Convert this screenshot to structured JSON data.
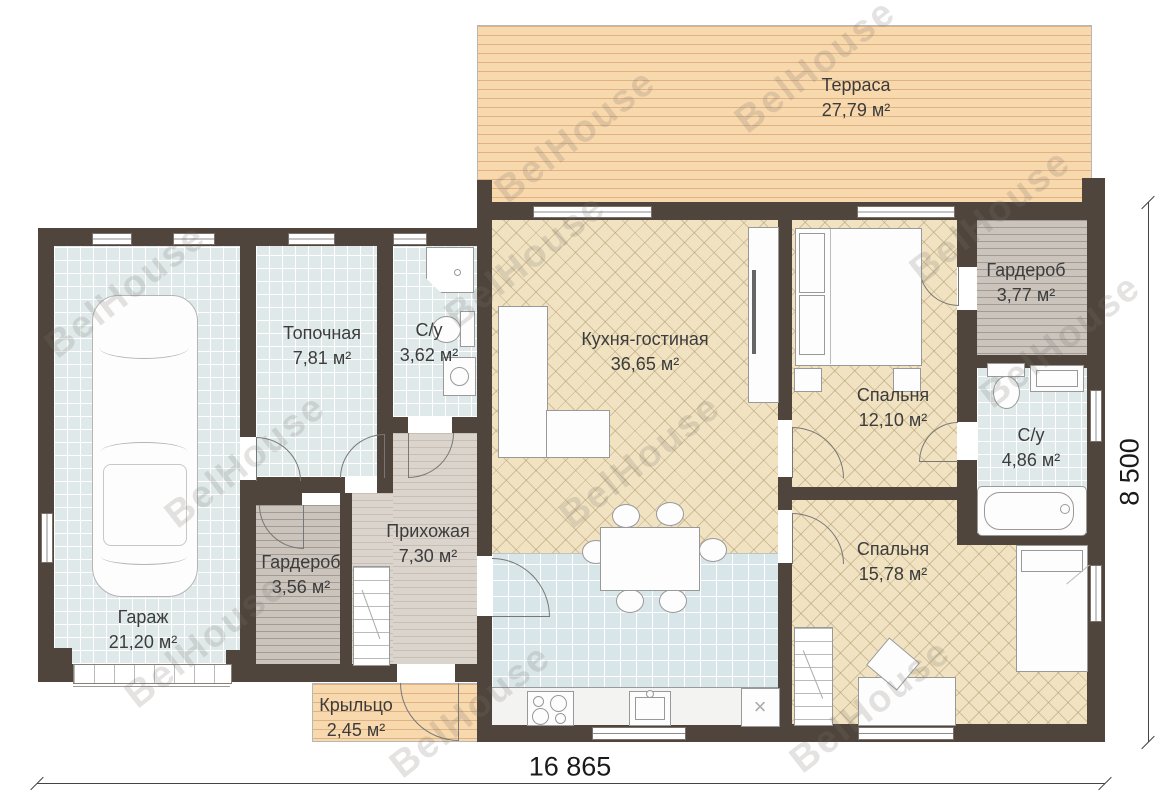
{
  "watermark": "BelHouse",
  "rooms": [
    {
      "name": "Терраса",
      "area": "27,79 м²"
    },
    {
      "name": "Гараж",
      "area": "21,20 м²"
    },
    {
      "name": "Топочная",
      "area": "7,81 м²"
    },
    {
      "name": "С/у",
      "area": "3,62 м²"
    },
    {
      "name": "Кухня-гостиная",
      "area": "36,65 м²"
    },
    {
      "name": "Спальня",
      "area": "12,10 м²"
    },
    {
      "name": "Гардероб",
      "area": "3,77 м²"
    },
    {
      "name": "С/у",
      "area": "4,86 м²"
    },
    {
      "name": "Спальня",
      "area": "15,78 м²"
    },
    {
      "name": "Гардероб",
      "area": "3,56 м²"
    },
    {
      "name": "Прихожая",
      "area": "7,30 м²"
    },
    {
      "name": "Крыльцо",
      "area": "2,45 м²"
    }
  ],
  "dimensions": {
    "bottom": "16 865",
    "right": "8 500"
  },
  "icons": {
    "x_mark": "×"
  },
  "colors": {
    "wall": "#4f453c",
    "terrace_deck": "#f8d8ad",
    "tile": "#dfe9ea",
    "kitchen_tile": "#d9e6e9",
    "parquet": "#f1e3c2",
    "stripe_floor": "#cbc4bd",
    "hall_floor": "#dbd4cc"
  }
}
